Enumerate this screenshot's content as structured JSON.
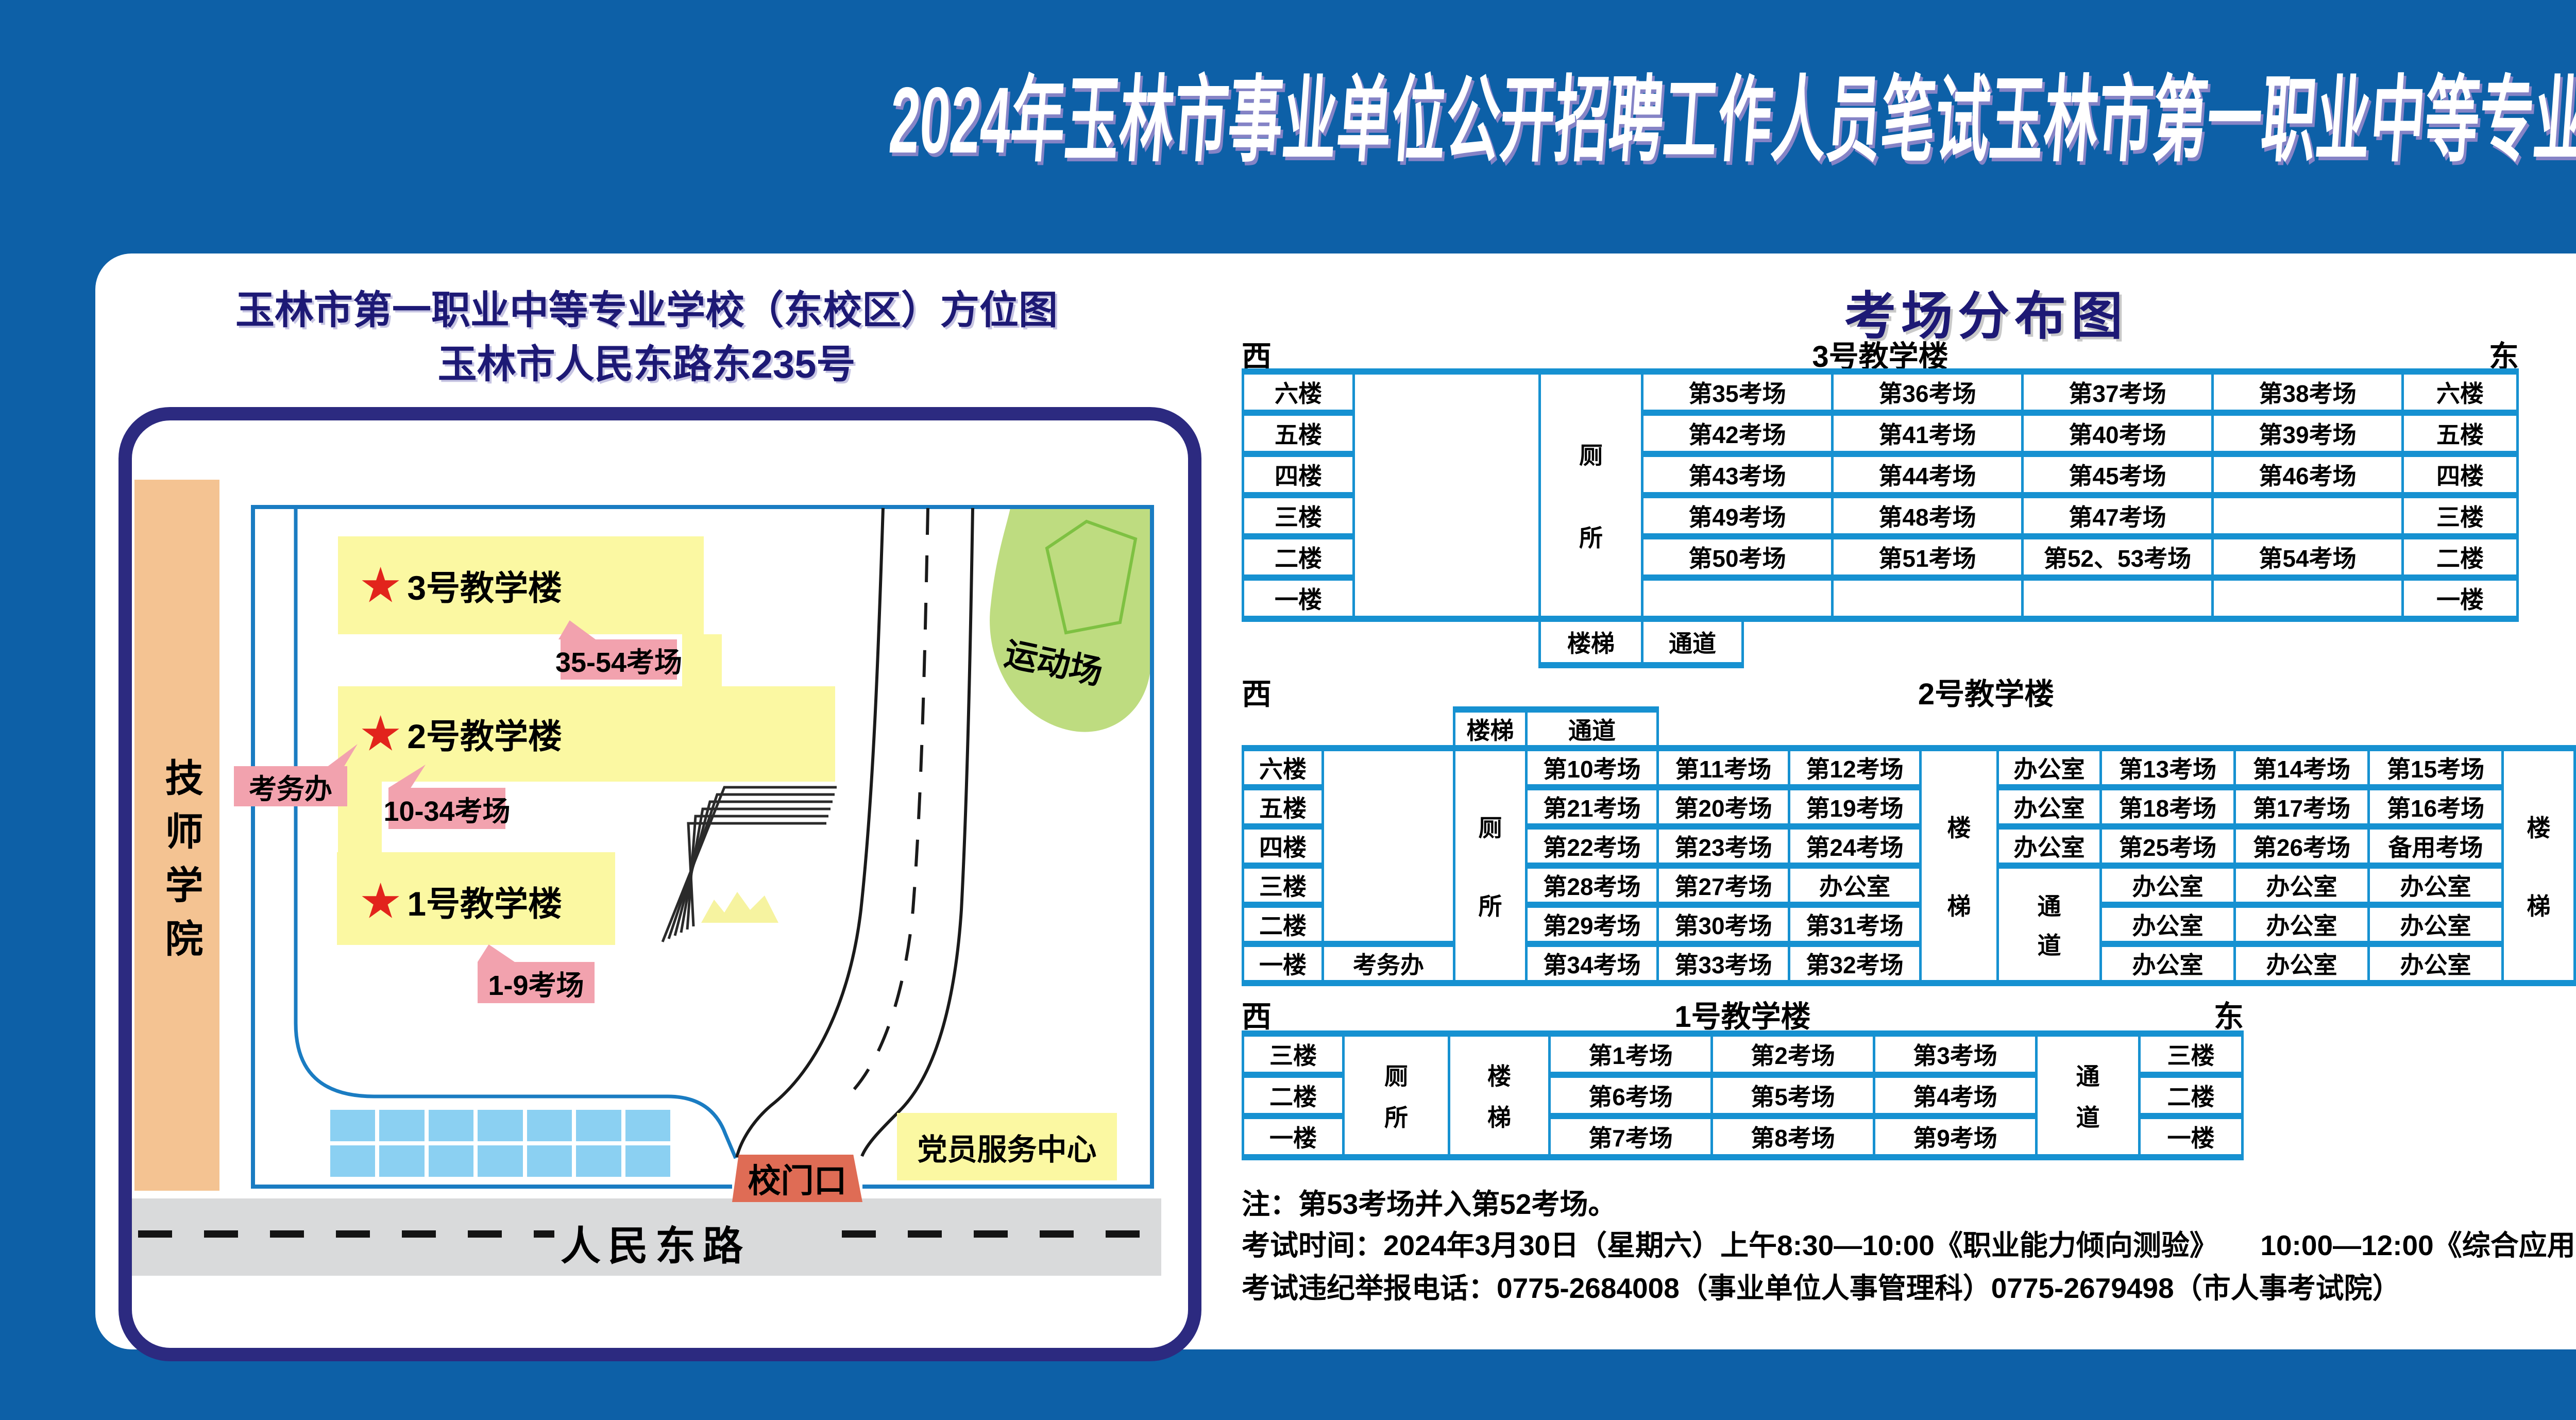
{
  "page_title": "2024年玉林市事业单位公开招聘工作人员笔试玉林市第一职业中等专业学校（东校区）考点考场示意图",
  "colors": {
    "background": "#0d60a7",
    "table_border": "#1691d1",
    "navy_text": "#1d1975",
    "map_border": "#2c2a80",
    "building_yellow": "#fbf8a2",
    "callout_pink": "#f2a2ae",
    "gate_salmon": "#df6c55",
    "field_green": "#bedc80",
    "track_green": "#7ec142",
    "parking_blue": "#8bd0f2",
    "road_gray": "#d9dadb",
    "star_red": "#e2241c",
    "strip_orange": "#f4c392"
  },
  "map": {
    "title_line1": "玉林市第一职业中等专业学校（东校区）方位图",
    "title_line2": "玉林市人民东路东235号",
    "tech_college": "技师学院",
    "sports_field": "运动场",
    "gate": "校门口",
    "party_center": "党员服务中心",
    "road": "人民东路",
    "exam_office": "考务办",
    "buildings": [
      {
        "name": "3号教学楼",
        "callout": "35-54考场"
      },
      {
        "name": "2号教学楼",
        "callout": "10-34考场"
      },
      {
        "name": "1号教学楼",
        "callout": "1-9考场"
      }
    ]
  },
  "distribution": {
    "title": "考场分布图",
    "west": "西",
    "east": "东",
    "stairs": "楼梯",
    "passage": "通道",
    "toilet": "厕所",
    "office": "办公室",
    "exam_office": "考务办",
    "building3": {
      "name": "3号教学楼",
      "floors": [
        "六楼",
        "五楼",
        "四楼",
        "三楼",
        "二楼",
        "一楼"
      ],
      "rows": [
        [
          "第35考场",
          "第36考场",
          "第37考场",
          "第38考场"
        ],
        [
          "第42考场",
          "第41考场",
          "第40考场",
          "第39考场"
        ],
        [
          "第43考场",
          "第44考场",
          "第45考场",
          "第46考场"
        ],
        [
          "第49考场",
          "第48考场",
          "第47考场",
          ""
        ],
        [
          "第50考场",
          "第51考场",
          "第52、53考场",
          "第54考场"
        ],
        [
          "",
          "",
          "",
          ""
        ]
      ]
    },
    "building2": {
      "name": "2号教学楼",
      "floors": [
        "六楼",
        "五楼",
        "四楼",
        "三楼",
        "二楼",
        "一楼"
      ],
      "west_rows": [
        [
          "第10考场",
          "第11考场",
          "第12考场"
        ],
        [
          "第21考场",
          "第20考场",
          "第19考场"
        ],
        [
          "第22考场",
          "第23考场",
          "第24考场"
        ],
        [
          "第28考场",
          "第27考场",
          "办公室"
        ],
        [
          "第29考场",
          "第30考场",
          "第31考场"
        ],
        [
          "第34考场",
          "第33考场",
          "第32考场"
        ]
      ],
      "mid_top": [
        "办公室",
        "办公室",
        "办公室"
      ],
      "east_rows": [
        [
          "第13考场",
          "第14考场",
          "第15考场"
        ],
        [
          "第18考场",
          "第17考场",
          "第16考场"
        ],
        [
          "第25考场",
          "第26考场",
          "备用考场"
        ],
        [
          "办公室",
          "办公室",
          "办公室"
        ],
        [
          "办公室",
          "办公室",
          "办公室"
        ],
        [
          "办公室",
          "办公室",
          "办公室"
        ]
      ]
    },
    "building1": {
      "name": "1号教学楼",
      "floors": [
        "三楼",
        "二楼",
        "一楼"
      ],
      "rows": [
        [
          "第1考场",
          "第2考场",
          "第3考场"
        ],
        [
          "第6考场",
          "第5考场",
          "第4考场"
        ],
        [
          "第7考场",
          "第8考场",
          "第9考场"
        ]
      ]
    }
  },
  "notes": {
    "note1": "注：第53考场并入第52考场。",
    "note2": "考试时间：2024年3月30日（星期六）上午8:30—10:00《职业能力倾向测验》　　10:00—12:00《综合应用能力》",
    "note3": "考试违纪举报电话：0775-2684008（事业单位人事管理科）0775-2679498（市人事考试院）"
  }
}
